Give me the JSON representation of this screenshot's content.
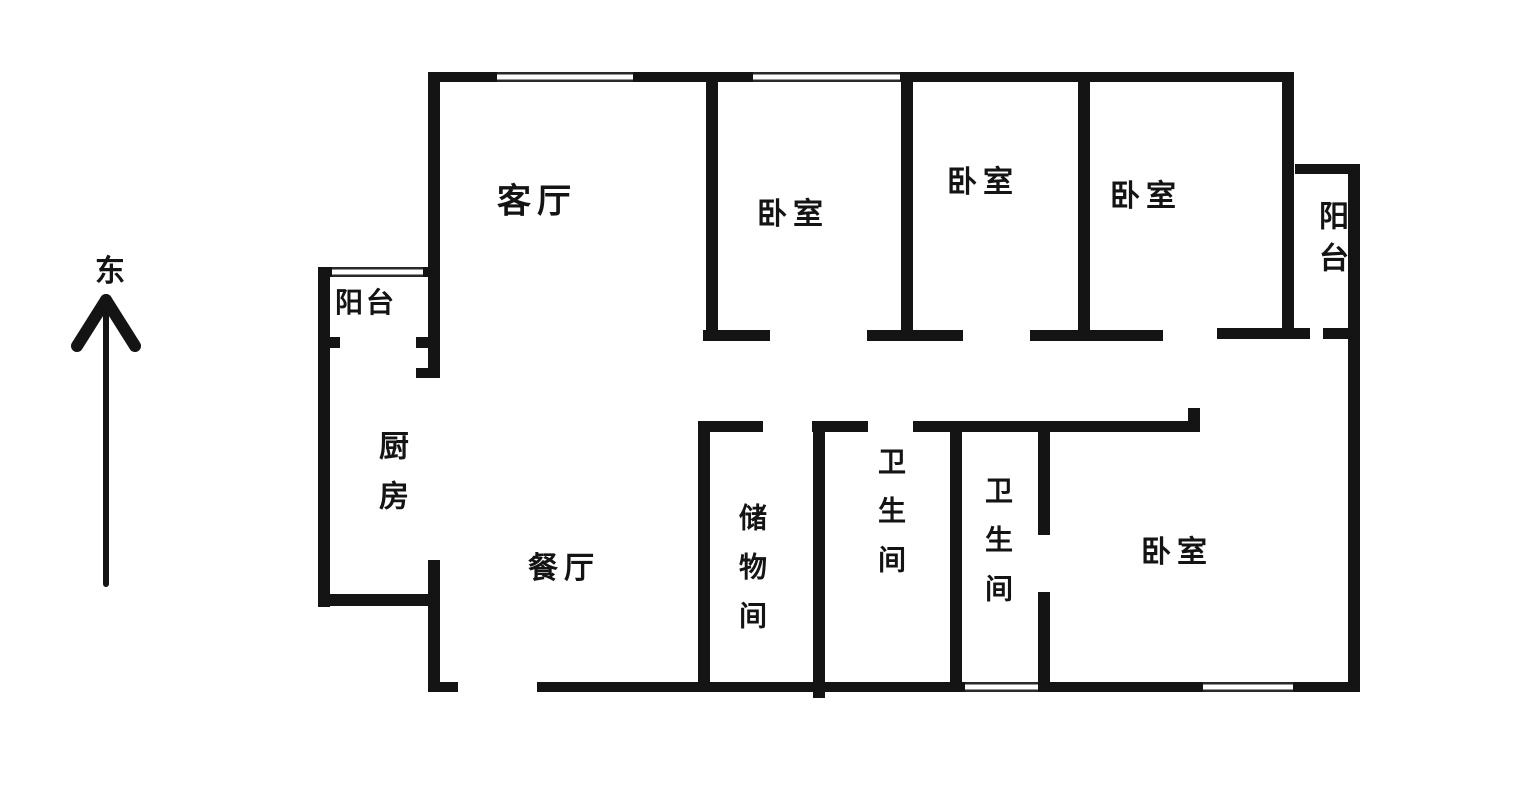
{
  "compass": {
    "direction_label": "东"
  },
  "rooms": {
    "living_room": {
      "label": "客厅"
    },
    "balcony_left": {
      "label": "阳台"
    },
    "bedroom_1": {
      "label": "卧室"
    },
    "bedroom_2": {
      "label": "卧室"
    },
    "bedroom_3": {
      "label": "卧室"
    },
    "balcony_right": {
      "label": "阳台"
    },
    "kitchen": {
      "label": "厨房"
    },
    "dining_room": {
      "label": "餐厅"
    },
    "storage_room": {
      "label": "储物间"
    },
    "bathroom_1": {
      "label": "卫生间"
    },
    "bathroom_2": {
      "label": "卫生间"
    },
    "bedroom_4": {
      "label": "卧室"
    }
  },
  "colors": {
    "wall": "#141414",
    "background": "#ffffff",
    "text": "#141414",
    "window_line": "#2a2a2a"
  }
}
